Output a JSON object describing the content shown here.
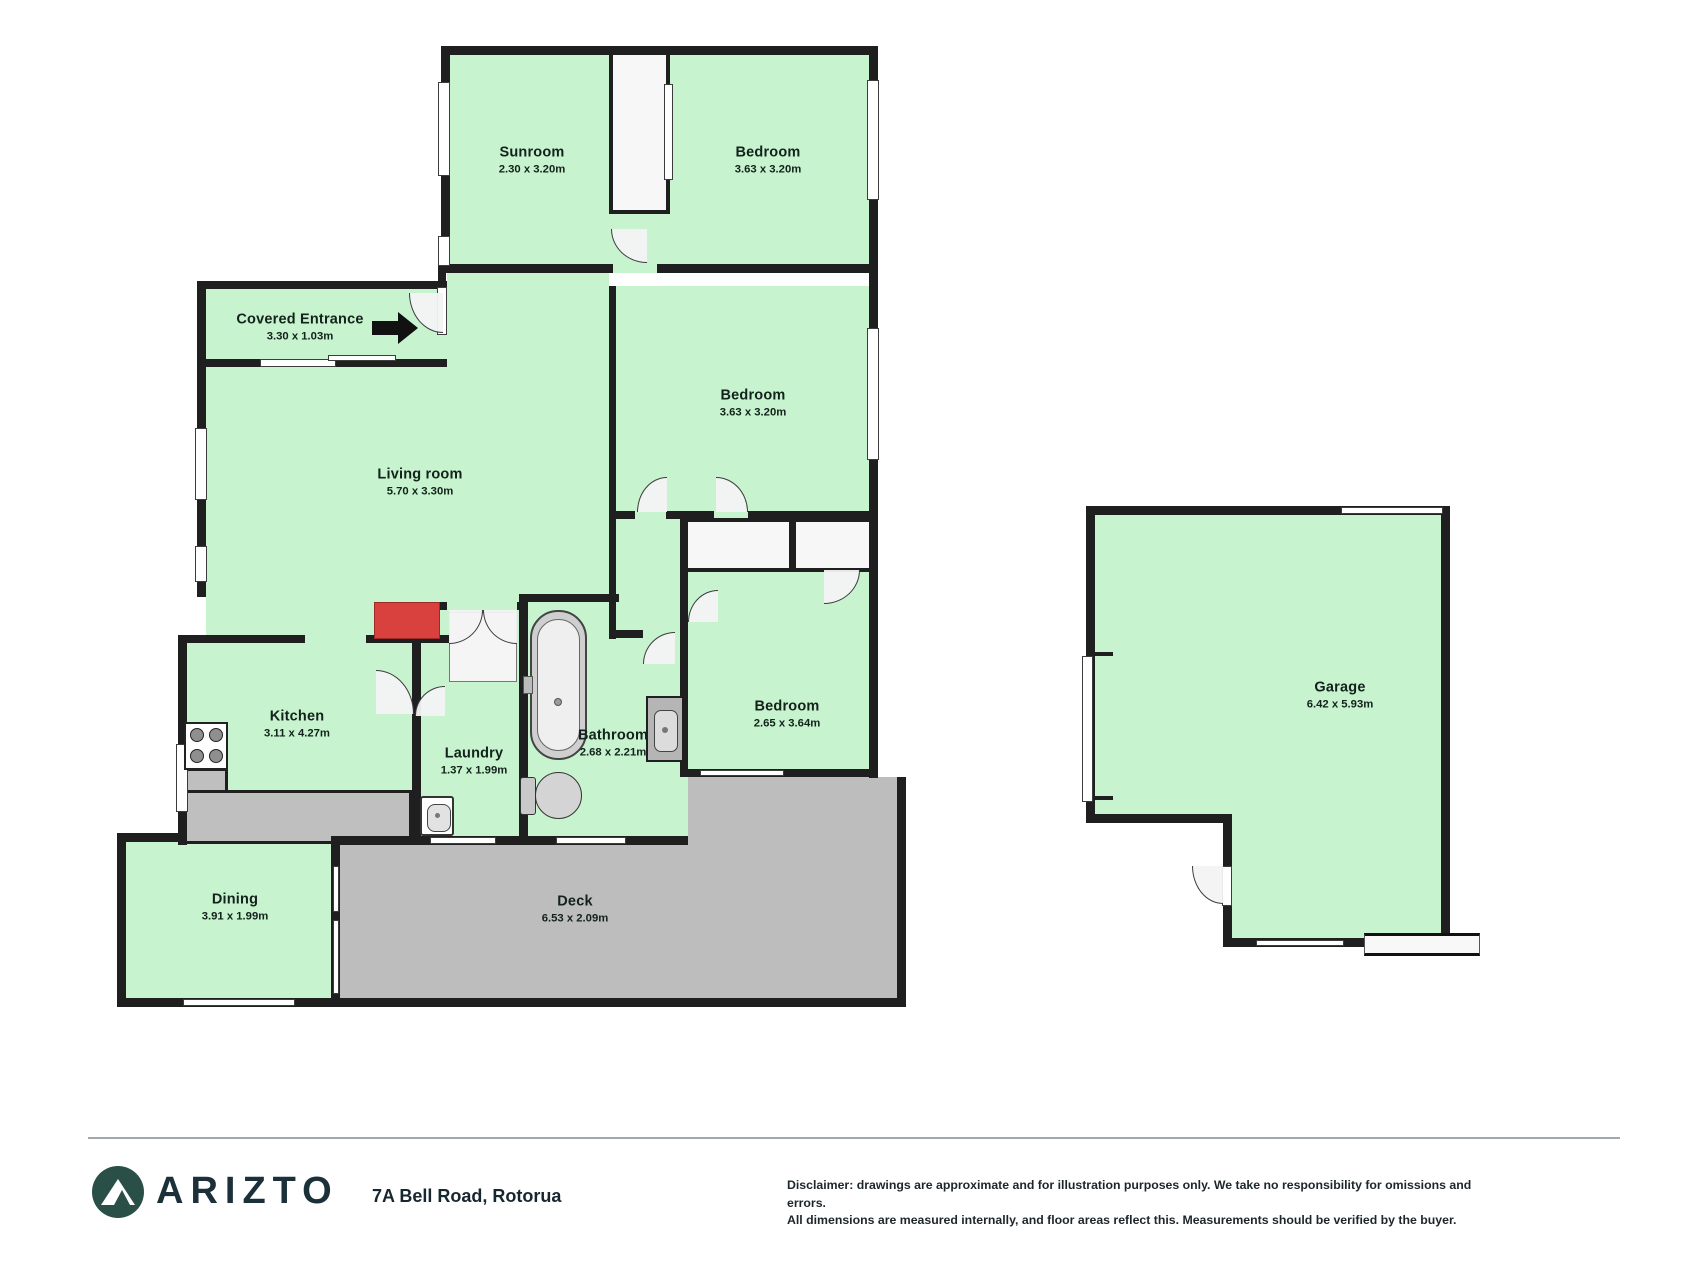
{
  "floorplan": {
    "rooms": {
      "sunroom": {
        "name": "Sunroom",
        "dims": "2.30 x 3.20m"
      },
      "bedroom1": {
        "name": "Bedroom",
        "dims": "3.63 x 3.20m"
      },
      "entrance": {
        "name": "Covered Entrance",
        "dims": "3.30 x 1.03m"
      },
      "living": {
        "name": "Living room",
        "dims": "5.70 x 3.30m"
      },
      "bedroom2": {
        "name": "Bedroom",
        "dims": "3.63 x 3.20m"
      },
      "kitchen": {
        "name": "Kitchen",
        "dims": "3.11 x 4.27m"
      },
      "laundry": {
        "name": "Laundry",
        "dims": "1.37 x 1.99m"
      },
      "bathroom": {
        "name": "Bathroom",
        "dims": "2.68 x 2.21m"
      },
      "bedroom3": {
        "name": "Bedroom",
        "dims": "2.65 x 3.64m"
      },
      "dining": {
        "name": "Dining",
        "dims": "3.91 x 1.99m"
      },
      "deck": {
        "name": "Deck",
        "dims": "6.53 x 2.09m"
      },
      "garage": {
        "name": "Garage",
        "dims": "6.42 x 5.93m"
      }
    },
    "colors": {
      "room_fill": "#c7f3ce",
      "wall": "#1f1f1f",
      "deck_fill": "#bdbdbd",
      "accent_red": "#d9413e",
      "logo_green": "#2a4f46"
    }
  },
  "footer": {
    "brand": "ARIZTO",
    "address": "7A Bell Road, Rotorua",
    "disclaimer_line1": "Disclaimer: drawings are approximate and for illustration purposes only. We take no responsibility for omissions and errors.",
    "disclaimer_line2": "All dimensions are measured internally, and floor areas reflect this. Measurements should be verified by the buyer."
  }
}
